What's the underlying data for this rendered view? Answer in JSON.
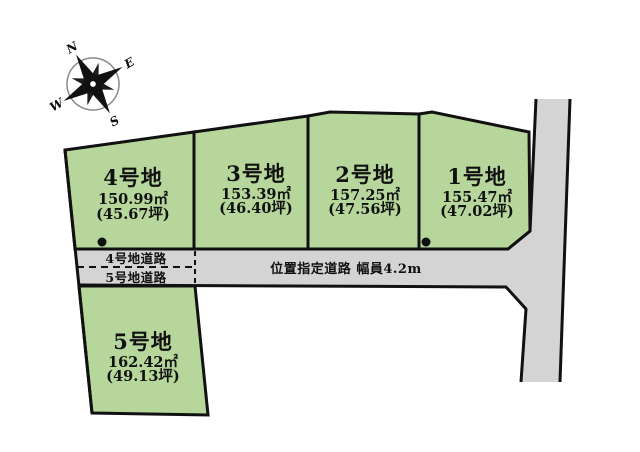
{
  "diagram_type": "residential-lot-layout-plan",
  "colors": {
    "plot_fill": "#b6d69b",
    "road_fill": "#d4d4d4",
    "line_color": "#111111",
    "background": "#ffffff"
  },
  "compass": {
    "north": "N",
    "east": "E",
    "south": "S",
    "west": "W"
  },
  "plots": [
    {
      "name": "1号地",
      "area_m2": "155.47㎡",
      "area_tsubo": "(47.02坪)"
    },
    {
      "name": "2号地",
      "area_m2": "157.25㎡",
      "area_tsubo": "(47.56坪)"
    },
    {
      "name": "3号地",
      "area_m2": "153.39㎡",
      "area_tsubo": "(46.40坪)"
    },
    {
      "name": "4号地",
      "area_m2": "150.99㎡",
      "area_tsubo": "(45.67坪)"
    },
    {
      "name": "5号地",
      "area_m2": "162.42㎡",
      "area_tsubo": "(49.13坪)"
    }
  ],
  "roads": {
    "main_label": "位置指定道路 幅員4.2m",
    "lot4_road_label": "4号地道路",
    "lot5_road_label": "5号地道路"
  }
}
